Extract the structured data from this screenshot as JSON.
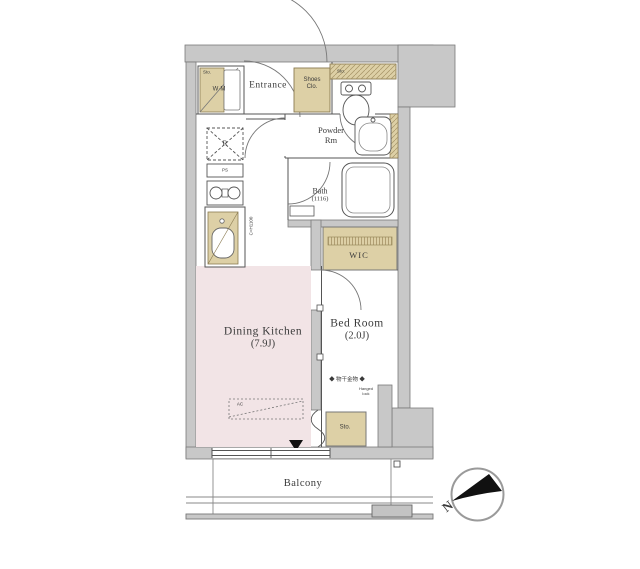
{
  "colors": {
    "wall_gray": "#c8c8c8",
    "closet_beige": "#ddd0a6",
    "dining_kitchen_pink": "#f2e4e6",
    "line": "#555555",
    "text": "#3a3a3a"
  },
  "rooms": {
    "entrance": {
      "label": "Entrance"
    },
    "shoes_closet": {
      "line1": "Shoes",
      "line2": "Clo."
    },
    "laundry": {
      "label": "W·M",
      "corner": "Sto."
    },
    "toilet_shelf": {
      "label": "Sto."
    },
    "powder_room": {
      "line1": "Powder",
      "line2": "Rm"
    },
    "bath": {
      "label": "Bath",
      "size": "(1116)"
    },
    "wic": {
      "label": "WIC"
    },
    "dining_kitchen": {
      "label": "Dining Kitchen",
      "size": "(7.9J)"
    },
    "bed_room": {
      "label": "Bed Room",
      "size": "(2.0J)"
    },
    "storage": {
      "label": "Sto."
    },
    "balcony": {
      "label": "Balcony"
    }
  },
  "annotations": {
    "refrigerator": "R",
    "pipe_shaft": "PS",
    "air_conditioner": "AC",
    "counter_height": "C=H1100",
    "drying_hardware": "◆ 物干金物 ◆",
    "window_note_line1": "Hanged",
    "window_note_line2": "lock"
  },
  "compass": {
    "north_label": "N"
  }
}
